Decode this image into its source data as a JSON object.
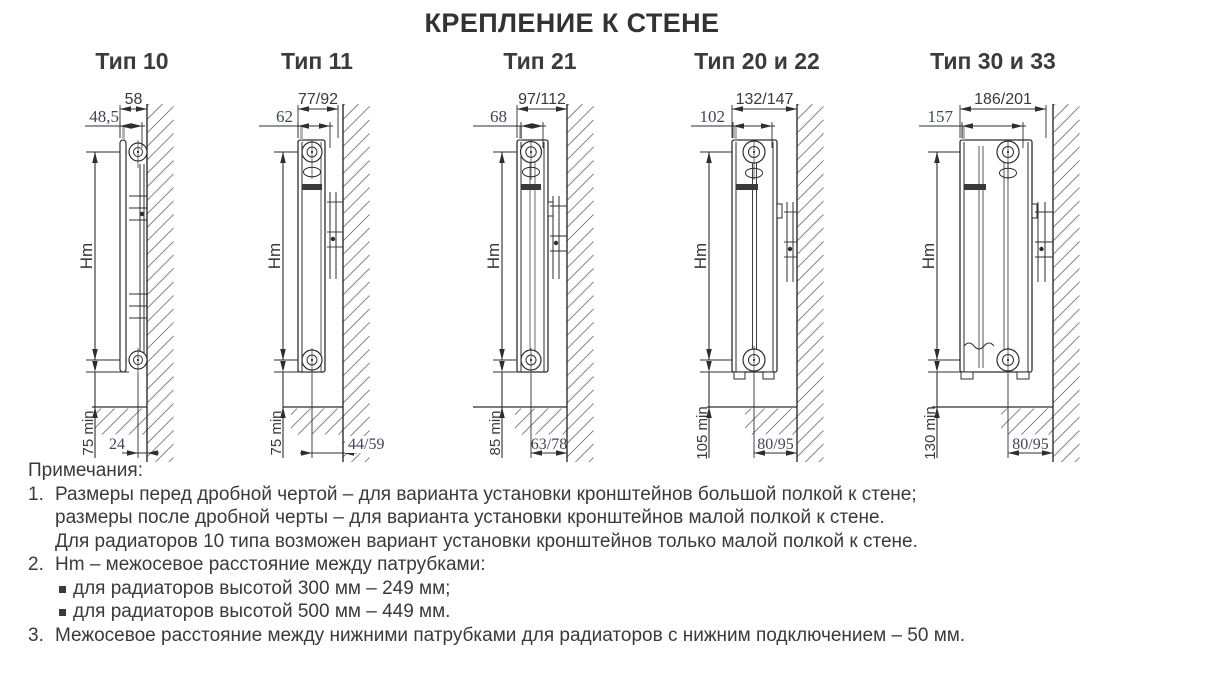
{
  "page_title": "КРЕПЛЕНИЕ К СТЕНЕ",
  "colors": {
    "line": "#2e2e2e",
    "label_text": "#3a3a3a",
    "cad_dim_text": "#3e4757"
  },
  "diagrams": [
    {
      "title": "Тип 10",
      "top_width": "58",
      "depth": "48,5",
      "axis_label": "Hm",
      "floor_clearance": "75 min",
      "bottom_offset": "24"
    },
    {
      "title": "Тип 11",
      "top_width": "77/92",
      "depth": "62",
      "axis_label": "Hm",
      "floor_clearance": "75 min",
      "bottom_offset": "44/59"
    },
    {
      "title": "Тип 21",
      "top_width": "97/112",
      "depth": "68",
      "axis_label": "Hm",
      "floor_clearance": "85 min",
      "bottom_offset": "63/78"
    },
    {
      "title": "Тип 20 и 22",
      "top_width": "132/147",
      "depth": "102",
      "axis_label": "Hm",
      "floor_clearance": "105 min",
      "bottom_offset": "80/95"
    },
    {
      "title": "Тип 30 и 33",
      "top_width": "186/201",
      "depth": "157",
      "axis_label": "Hm",
      "floor_clearance": "130 min",
      "bottom_offset": "80/95"
    }
  ],
  "notes": {
    "heading": "Примечания:",
    "items": [
      {
        "number": "1.",
        "lines": [
          "Размеры перед дробной чертой – для варианта установки кронштейнов большой полкой к стене;",
          "размеры после дробной черты – для варианта установки кронштейнов малой полкой к стене.",
          "Для радиаторов 10 типа возможен вариант установки кронштейнов только малой полкой к стене."
        ]
      },
      {
        "number": "2.",
        "lines": [
          "Hm – межосевое расстояние между патрубками:"
        ],
        "bullets": [
          "для радиаторов высотой 300 мм – 249 мм;",
          "для радиаторов высотой 500 мм – 449 мм."
        ]
      },
      {
        "number": "3.",
        "lines": [
          "Межосевое расстояние между нижними патрубками для радиаторов с нижним подключением – 50 мм."
        ]
      }
    ]
  }
}
